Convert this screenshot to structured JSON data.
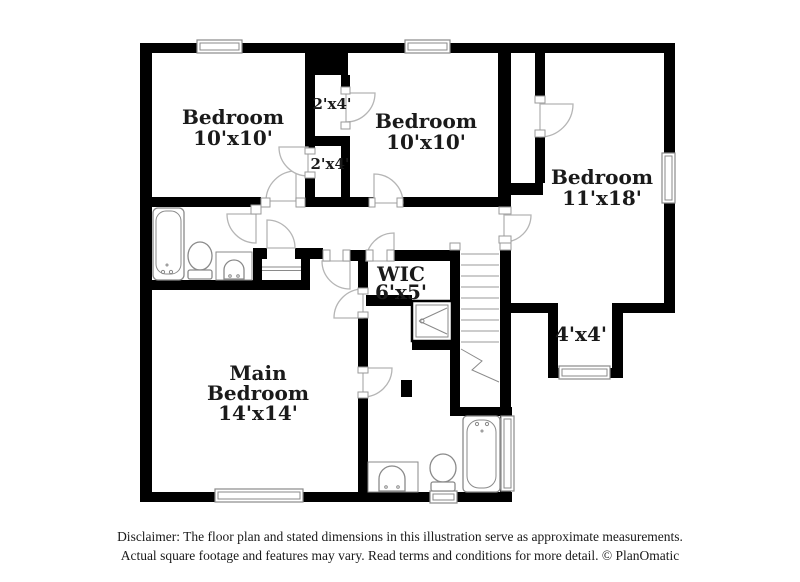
{
  "floor_plan": {
    "rooms": {
      "bedroom_top_left": {
        "name": "Bedroom",
        "dims": "10'x10'"
      },
      "bedroom_top_mid": {
        "name": "Bedroom",
        "dims": "10'x10'"
      },
      "bedroom_right": {
        "name": "Bedroom",
        "dims": "11'x18'"
      },
      "main_bedroom": {
        "line1": "Main",
        "line2": "Bedroom",
        "dims": "14'x14'"
      },
      "wic": {
        "name": "WIC",
        "dims": "6'x5'"
      },
      "closet_upper": {
        "dims": "2'x4'"
      },
      "closet_lower": {
        "dims": "2'x4'"
      },
      "nook": {
        "dims": "4'x4'"
      }
    },
    "colors": {
      "wall": "#000000",
      "fixture": "#8a8a8a",
      "door": "#b5b5b5",
      "text": "#1a1a1a",
      "background": "#ffffff"
    },
    "disclaimer": {
      "line1": "Disclaimer: The floor plan and stated dimensions in this illustration serve as approximate measurements.",
      "line2": "Actual square footage and features may vary. Read terms and conditions for more detail. © PlanOmatic"
    }
  }
}
